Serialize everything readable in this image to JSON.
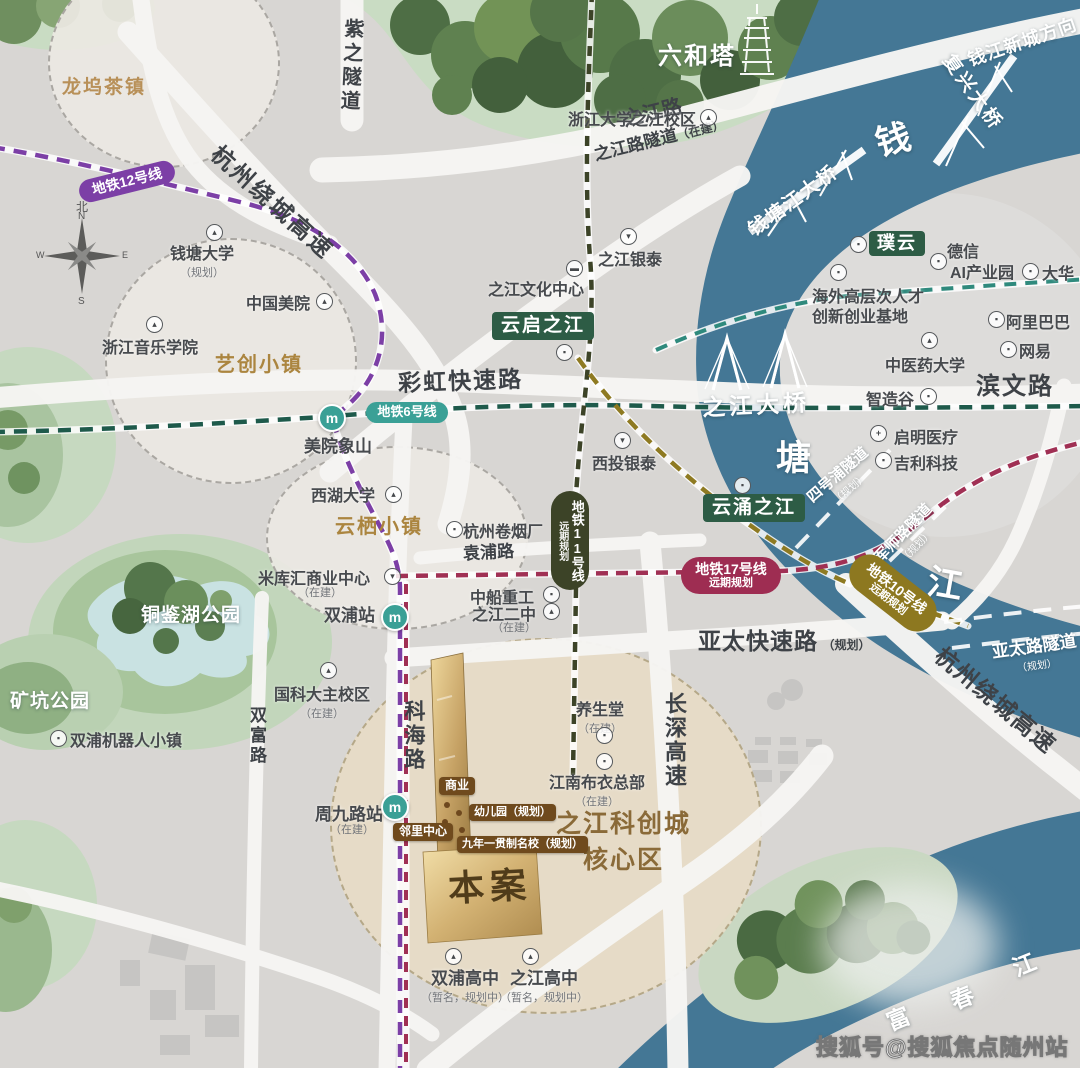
{
  "colors": {
    "river": "#447795",
    "land": "#d8d6d3",
    "gold": "#c9a668",
    "badge_green": "#2d5c45",
    "badge_brown": "#6f4a1d",
    "metro12": "#7c3fa6",
    "metro6": "#1e5a4b",
    "metro11": "#3c4327",
    "metro17": "#a03054",
    "metro10": "#8e7a22",
    "metro_station": "#3aa096",
    "zone_fill": "#eae7e2",
    "project_fill": "#e6dcc7",
    "forest": "#4e6e45",
    "park": "#c2d6bb",
    "lake": "#c9e2e2"
  },
  "compass": {
    "north_cn": "北",
    "n": "N",
    "s": "S",
    "w": "W",
    "e": "E"
  },
  "watermark": {
    "text": "搜狐号@搜狐焦点随州站"
  },
  "zones": {
    "longwu": "龙坞茶镇",
    "yichuang": "艺创小镇",
    "yunqi": "云栖小镇"
  },
  "rivers": {
    "qian": "钱",
    "tang": "塘",
    "jiang": "江",
    "fu": "富",
    "chun": "春",
    "jiang2": "江",
    "direction": "钱江新城方向"
  },
  "bridges": {
    "fuxing": "复兴大桥",
    "qiantang": "钱塘江大桥",
    "zhijiang": "之江大桥"
  },
  "roads": {
    "zizhi": "紫之隧道",
    "zhijiang_lu": "之江路",
    "zhijiang_tunnel": "之江路隧道",
    "zhijiang_tunnel_sub": "（在建）",
    "raocheng_nw": "杭州绕城高速",
    "caihong": "彩虹快速路",
    "binwen": "滨文路",
    "yuanpu": "袁浦路",
    "kehai": "科海路",
    "shuangfu": "双富路",
    "changshen": "长深高速",
    "yatai": "亚太快速路",
    "yatai_sub": "（规划）",
    "raocheng_se": "杭州绕城高速"
  },
  "tunnels": {
    "sihao": "四号浦隧道",
    "sihao_sub": "（规划）",
    "junshi": "军师路隧道",
    "junshi_sub": "（规划）",
    "yatai_sui": "亚太路隧道",
    "yatai_sui_sub": "（规划）"
  },
  "metro": {
    "line12": "地铁12号线",
    "line6": "地铁6号线",
    "line11": "地铁11号线",
    "line11_sub": "远期规划",
    "line17": "地铁17号线",
    "line17_sub": "远期规划",
    "line10": "地铁10号线",
    "line10_sub": "远期规划"
  },
  "stations": {
    "m": "m",
    "meiyuanxiangshan": "美院象山",
    "shuangpu": "双浦站",
    "zhoujiulu": "周九路站",
    "zhoujiulu_sub": "（在建）"
  },
  "badges": {
    "yunqizhijiang": "云启之江",
    "yunyongzhijiang": "云涌之江",
    "puyun": "璞云"
  },
  "project": {
    "name": "本案",
    "zone_line1": "之江科创城",
    "zone_line2": "核心区",
    "shangye": "商业",
    "youeryuan": "幼儿园（规划）",
    "linli": "邻里中心",
    "mingxiao": "九年一贯制名校（规划）"
  },
  "pois": {
    "liuhe": {
      "text": "六和塔"
    },
    "zheda": {
      "text": "浙江大学之江校区"
    },
    "qiantang_univ": {
      "text": "钱塘大学",
      "sub": "（规划）"
    },
    "meiyuan": {
      "text": "中国美院"
    },
    "yinyue": {
      "text": "浙江音乐学院"
    },
    "wenhua": {
      "text": "之江文化中心"
    },
    "yintai": {
      "text": "之江银泰"
    },
    "dexin1": {
      "text": "德信"
    },
    "dexin2": {
      "text": "AI产业园"
    },
    "dahua": {
      "text": "大华"
    },
    "haiwai1": {
      "text": "海外高层次人才"
    },
    "haiwai2": {
      "text": "创新创业基地"
    },
    "alibaba": {
      "text": "阿里巴巴"
    },
    "wangyi": {
      "text": "网易"
    },
    "zhongyiyao": {
      "text": "中医药大学"
    },
    "zhizaogu": {
      "text": "智造谷"
    },
    "qiming": {
      "text": "启明医疗"
    },
    "jili": {
      "text": "吉利科技"
    },
    "xitou": {
      "text": "西投银泰"
    },
    "xihu": {
      "text": "西湖大学"
    },
    "juanyan": {
      "text": "杭州卷烟厂"
    },
    "mikuhui": {
      "text": "米库汇商业中心",
      "sub": "（在建）"
    },
    "zhongchuan": {
      "text": "中船重工"
    },
    "erzhong": {
      "text": "之江二中",
      "sub": "（在建）"
    },
    "guokeda": {
      "text": "国科大主校区",
      "sub": "（在建）"
    },
    "robot": {
      "text": "双浦机器人小镇"
    },
    "tongjianhu": {
      "text": "铜鉴湖公园"
    },
    "kuangkeng": {
      "text": "矿坑公园"
    },
    "yangshengtang": {
      "text": "养生堂",
      "sub": "（在建）"
    },
    "buyi": {
      "text": "江南布衣总部",
      "sub": "（在建）"
    },
    "shuangpu_hs": {
      "text": "双浦高中",
      "sub": "（暂名，规划中）"
    },
    "zhijiang_hs": {
      "text": "之江高中",
      "sub": "（暂名，规划中）"
    }
  },
  "icons": {
    "school": "▴",
    "building": "▪",
    "mall": "▾",
    "museum": "▬",
    "hospital": "+"
  }
}
